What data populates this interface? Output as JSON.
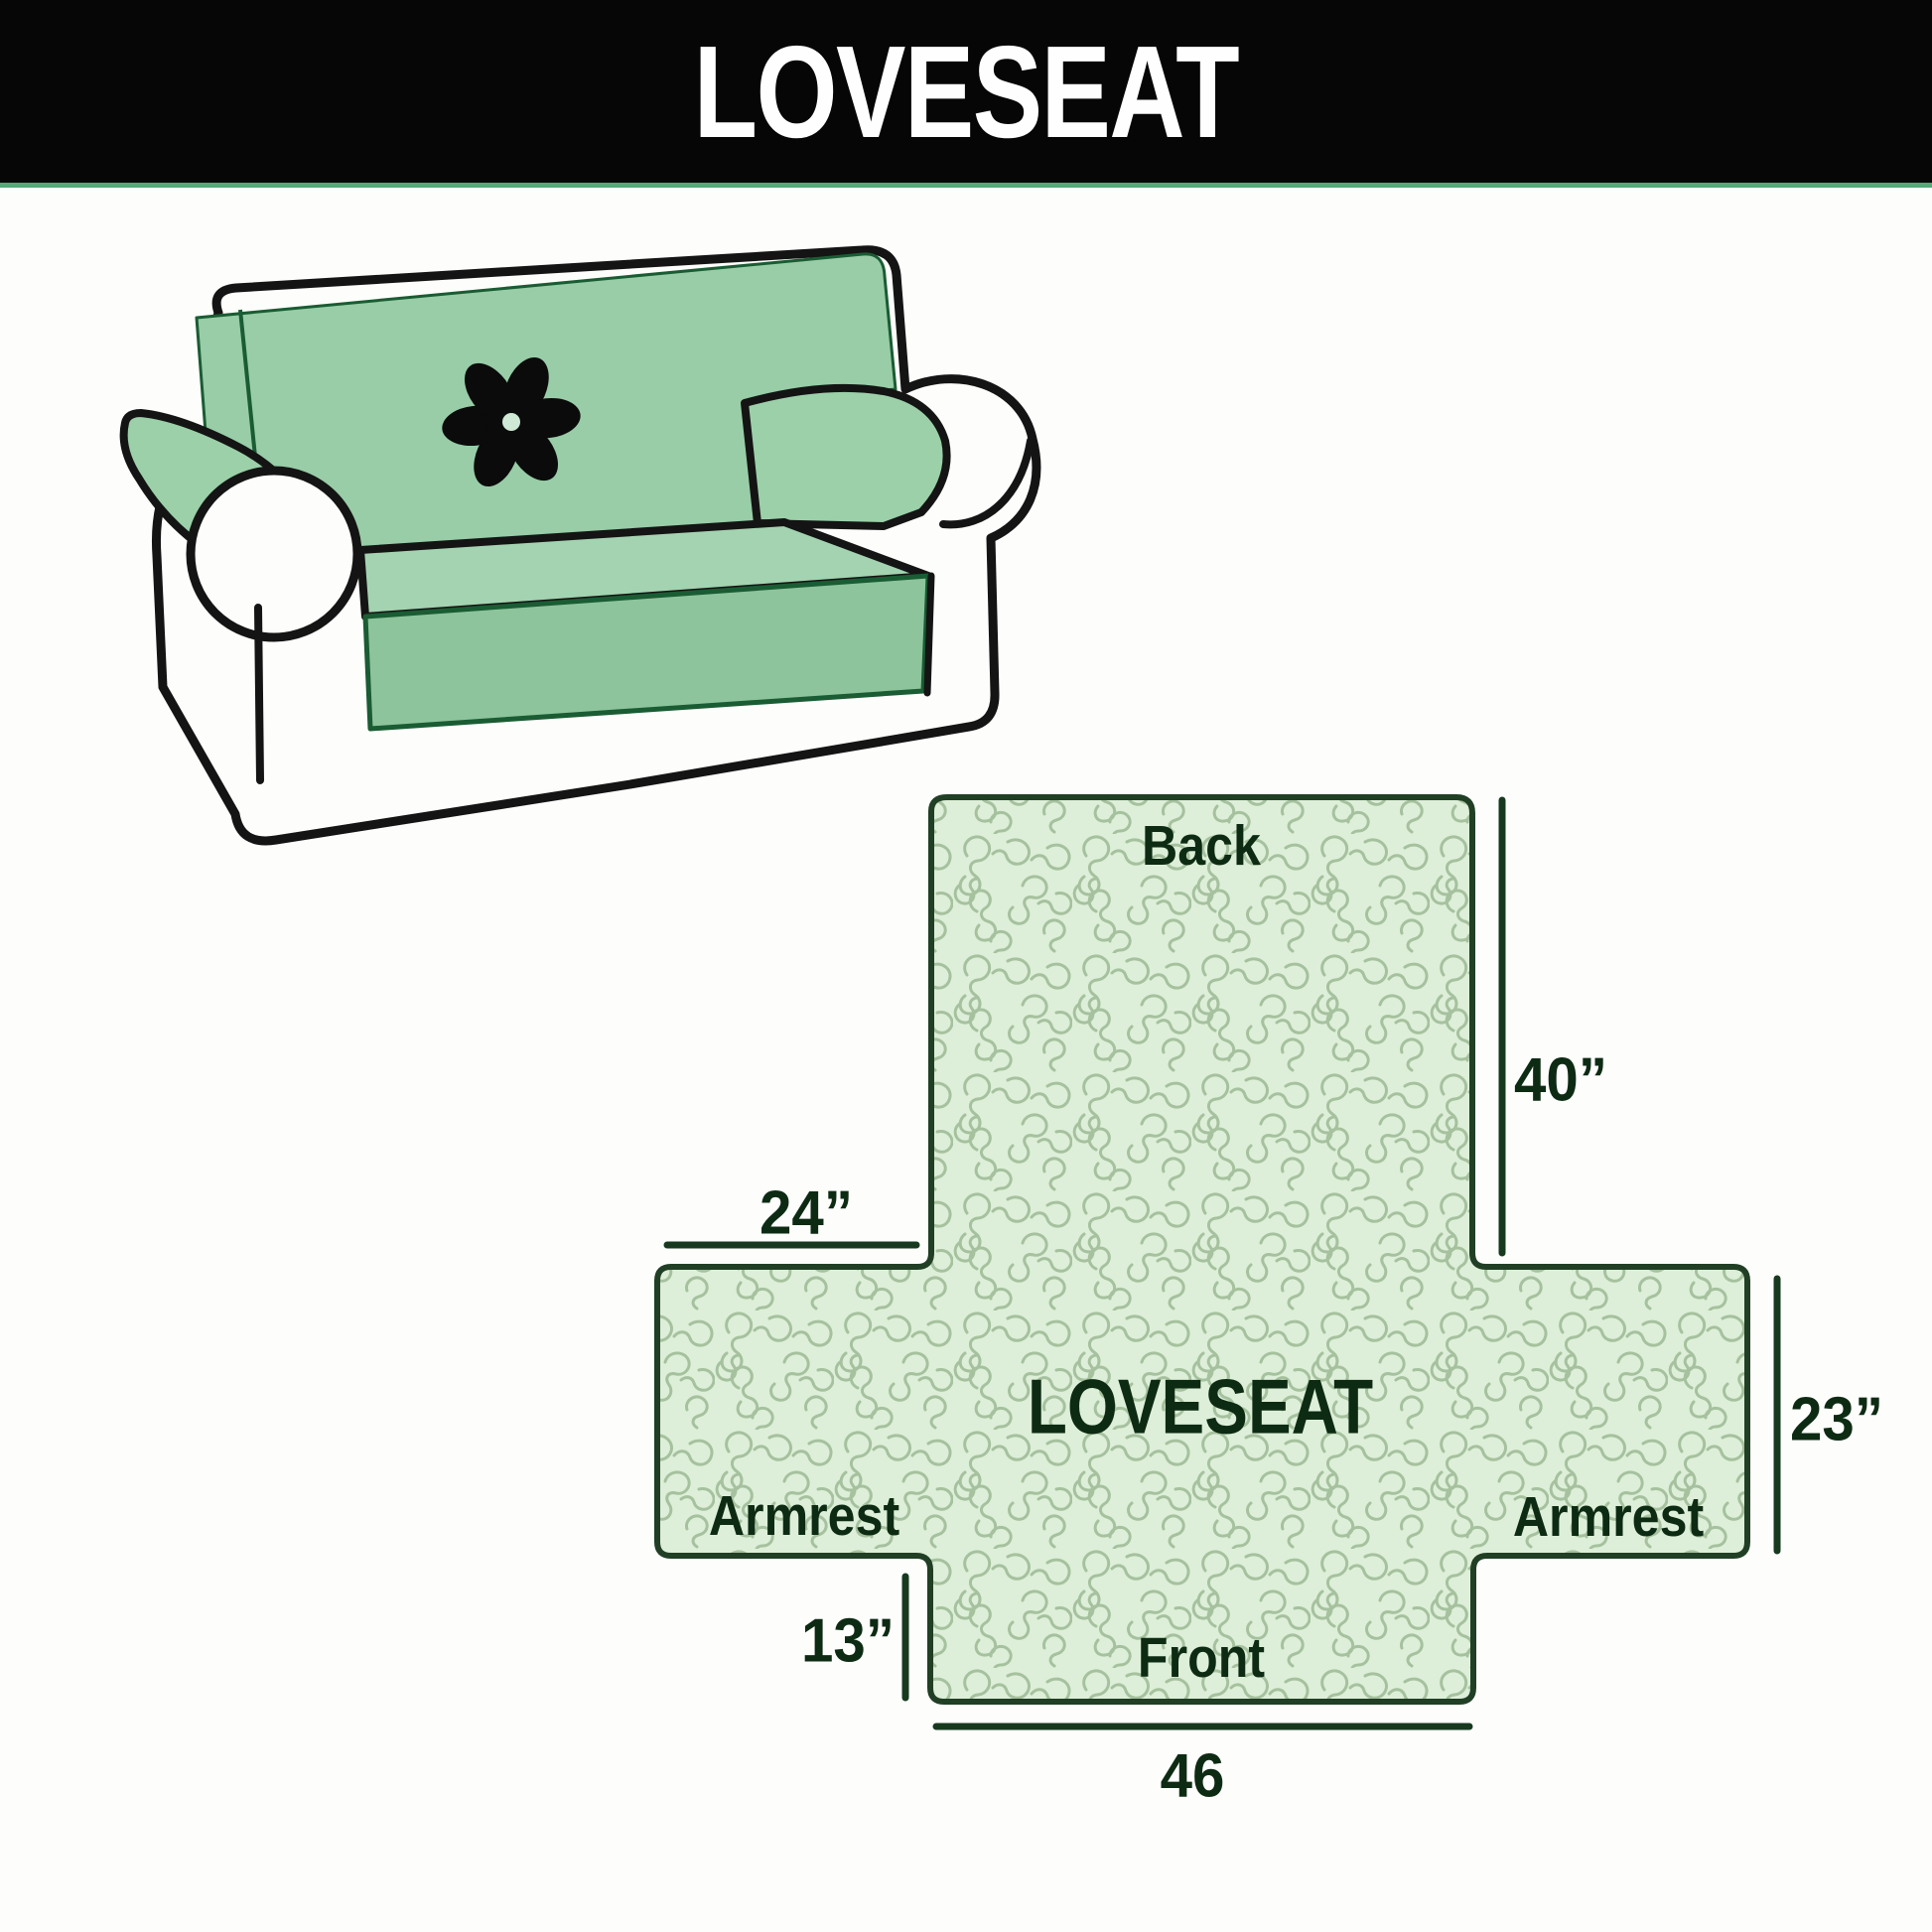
{
  "banner": {
    "title": "LOVESEAT"
  },
  "illustration": {
    "description": "loveseat with quilted slipcover",
    "logo_icon": "pinwheel-flower",
    "cover_color": "#98cda7",
    "outline_color": "#141414"
  },
  "diagram": {
    "center_label": "LOVESEAT",
    "sections": {
      "back": "Back",
      "front": "Front",
      "armrest_left": "Armrest",
      "armrest_right": "Armrest"
    },
    "dimensions": {
      "back_height": "40”",
      "armrest_top_width": "24”",
      "armrest_side_height": "23”",
      "front_side_height": "13”",
      "front_bottom_width": "46"
    },
    "colors": {
      "fill": "#ddefd8",
      "quilt_line": "#a6c19e",
      "border": "#203f24",
      "text": "#0d2b13"
    }
  }
}
